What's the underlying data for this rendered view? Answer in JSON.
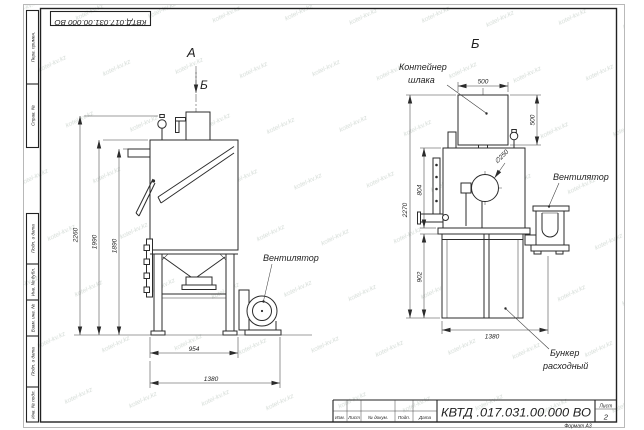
{
  "watermark": {
    "text": "kotel-kv.kz"
  },
  "frame": {
    "top_stamp": "КВТД.017.031.00.000  ВО",
    "side_top": [
      "Перв. примен.",
      "Справ. №"
    ],
    "side_bottom": [
      "Подп. и дата",
      "Инв. № дубл.",
      "Взам. инв. №",
      "Подп. и дата",
      "Инв. № подл."
    ]
  },
  "title_block": {
    "doc_number": "КВТД .017.031.00.000  ВО",
    "columns": [
      "Изм.",
      "Лист",
      "№ докум.",
      "Подп.",
      "Дата"
    ],
    "sheet_label": "Лист",
    "sheet_number": "2",
    "format": "Формат А3"
  },
  "front_view": {
    "view_label_a": "А",
    "view_label_b": "Б",
    "fan_label": "Вентилятор",
    "dim_height_total": "2260",
    "dim_height_body": "1990",
    "dim_height_door": "1890",
    "dim_width_body": "954",
    "dim_width_total": "1380"
  },
  "side_view": {
    "view_label": "Б",
    "container_label_line1": "Контейнер",
    "container_label_line2": "шлака",
    "fan_label": "Вентилятор",
    "hopper_label_line1": "Бункер",
    "hopper_label_line2": "расходный",
    "dim_container_width": "500",
    "dim_container_height": "500",
    "dim_diameter": "∅250",
    "dim_body_height": "804",
    "dim_height_total": "2270",
    "dim_hopper_height": "902",
    "dim_width": "1380"
  }
}
